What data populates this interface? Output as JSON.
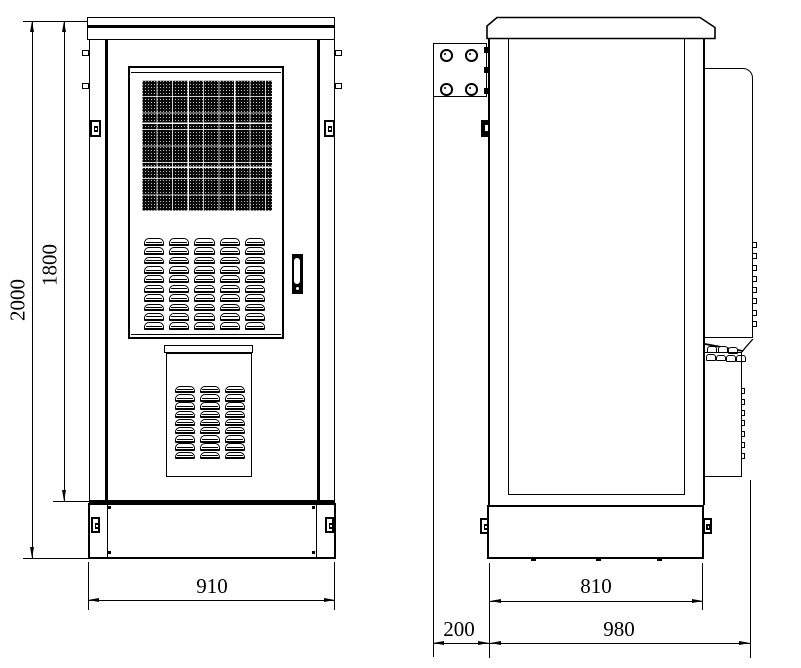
{
  "colors": {
    "line": "#000000",
    "background": "#ffffff"
  },
  "front_view": {
    "dim_overall_height": "2000",
    "dim_body_height": "1800",
    "dim_width": "910"
  },
  "side_view": {
    "dim_base_depth": "810",
    "dim_bracket_offset": "200",
    "dim_overall_depth": "980"
  }
}
